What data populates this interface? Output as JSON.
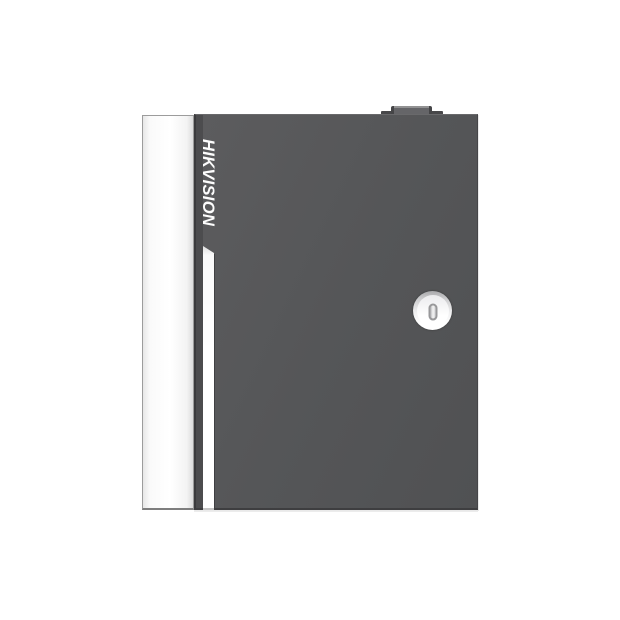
{
  "product": {
    "brand": "HIKVISION",
    "components": {
      "door": "front-door-panel",
      "side_panel": "left-side-panel",
      "lock": "round-cam-lock",
      "keyhole": "vertical-keyhole-slot",
      "stripe": "white-door-stripe",
      "top_knockout": "top-cable-knockout"
    }
  },
  "colors": {
    "background": "#ffffff",
    "door": "#565759",
    "door-edge-band": "#4c4c4e",
    "door-dark-edge": "#3b3b3d",
    "panel": "#fbfbfb",
    "panel-border": "#9c9c9c",
    "stripe": "#ffffff",
    "logo-text": "#fdfdfd",
    "knockout-base": "#48484a",
    "knockout-face": "#656568",
    "knockout-highlight": "#929293",
    "lock-rim": "#a9a9ab",
    "lock-face": "#ffffff",
    "keyhole-border": "#98989a",
    "keyhole-fill": "#d9d9db"
  }
}
